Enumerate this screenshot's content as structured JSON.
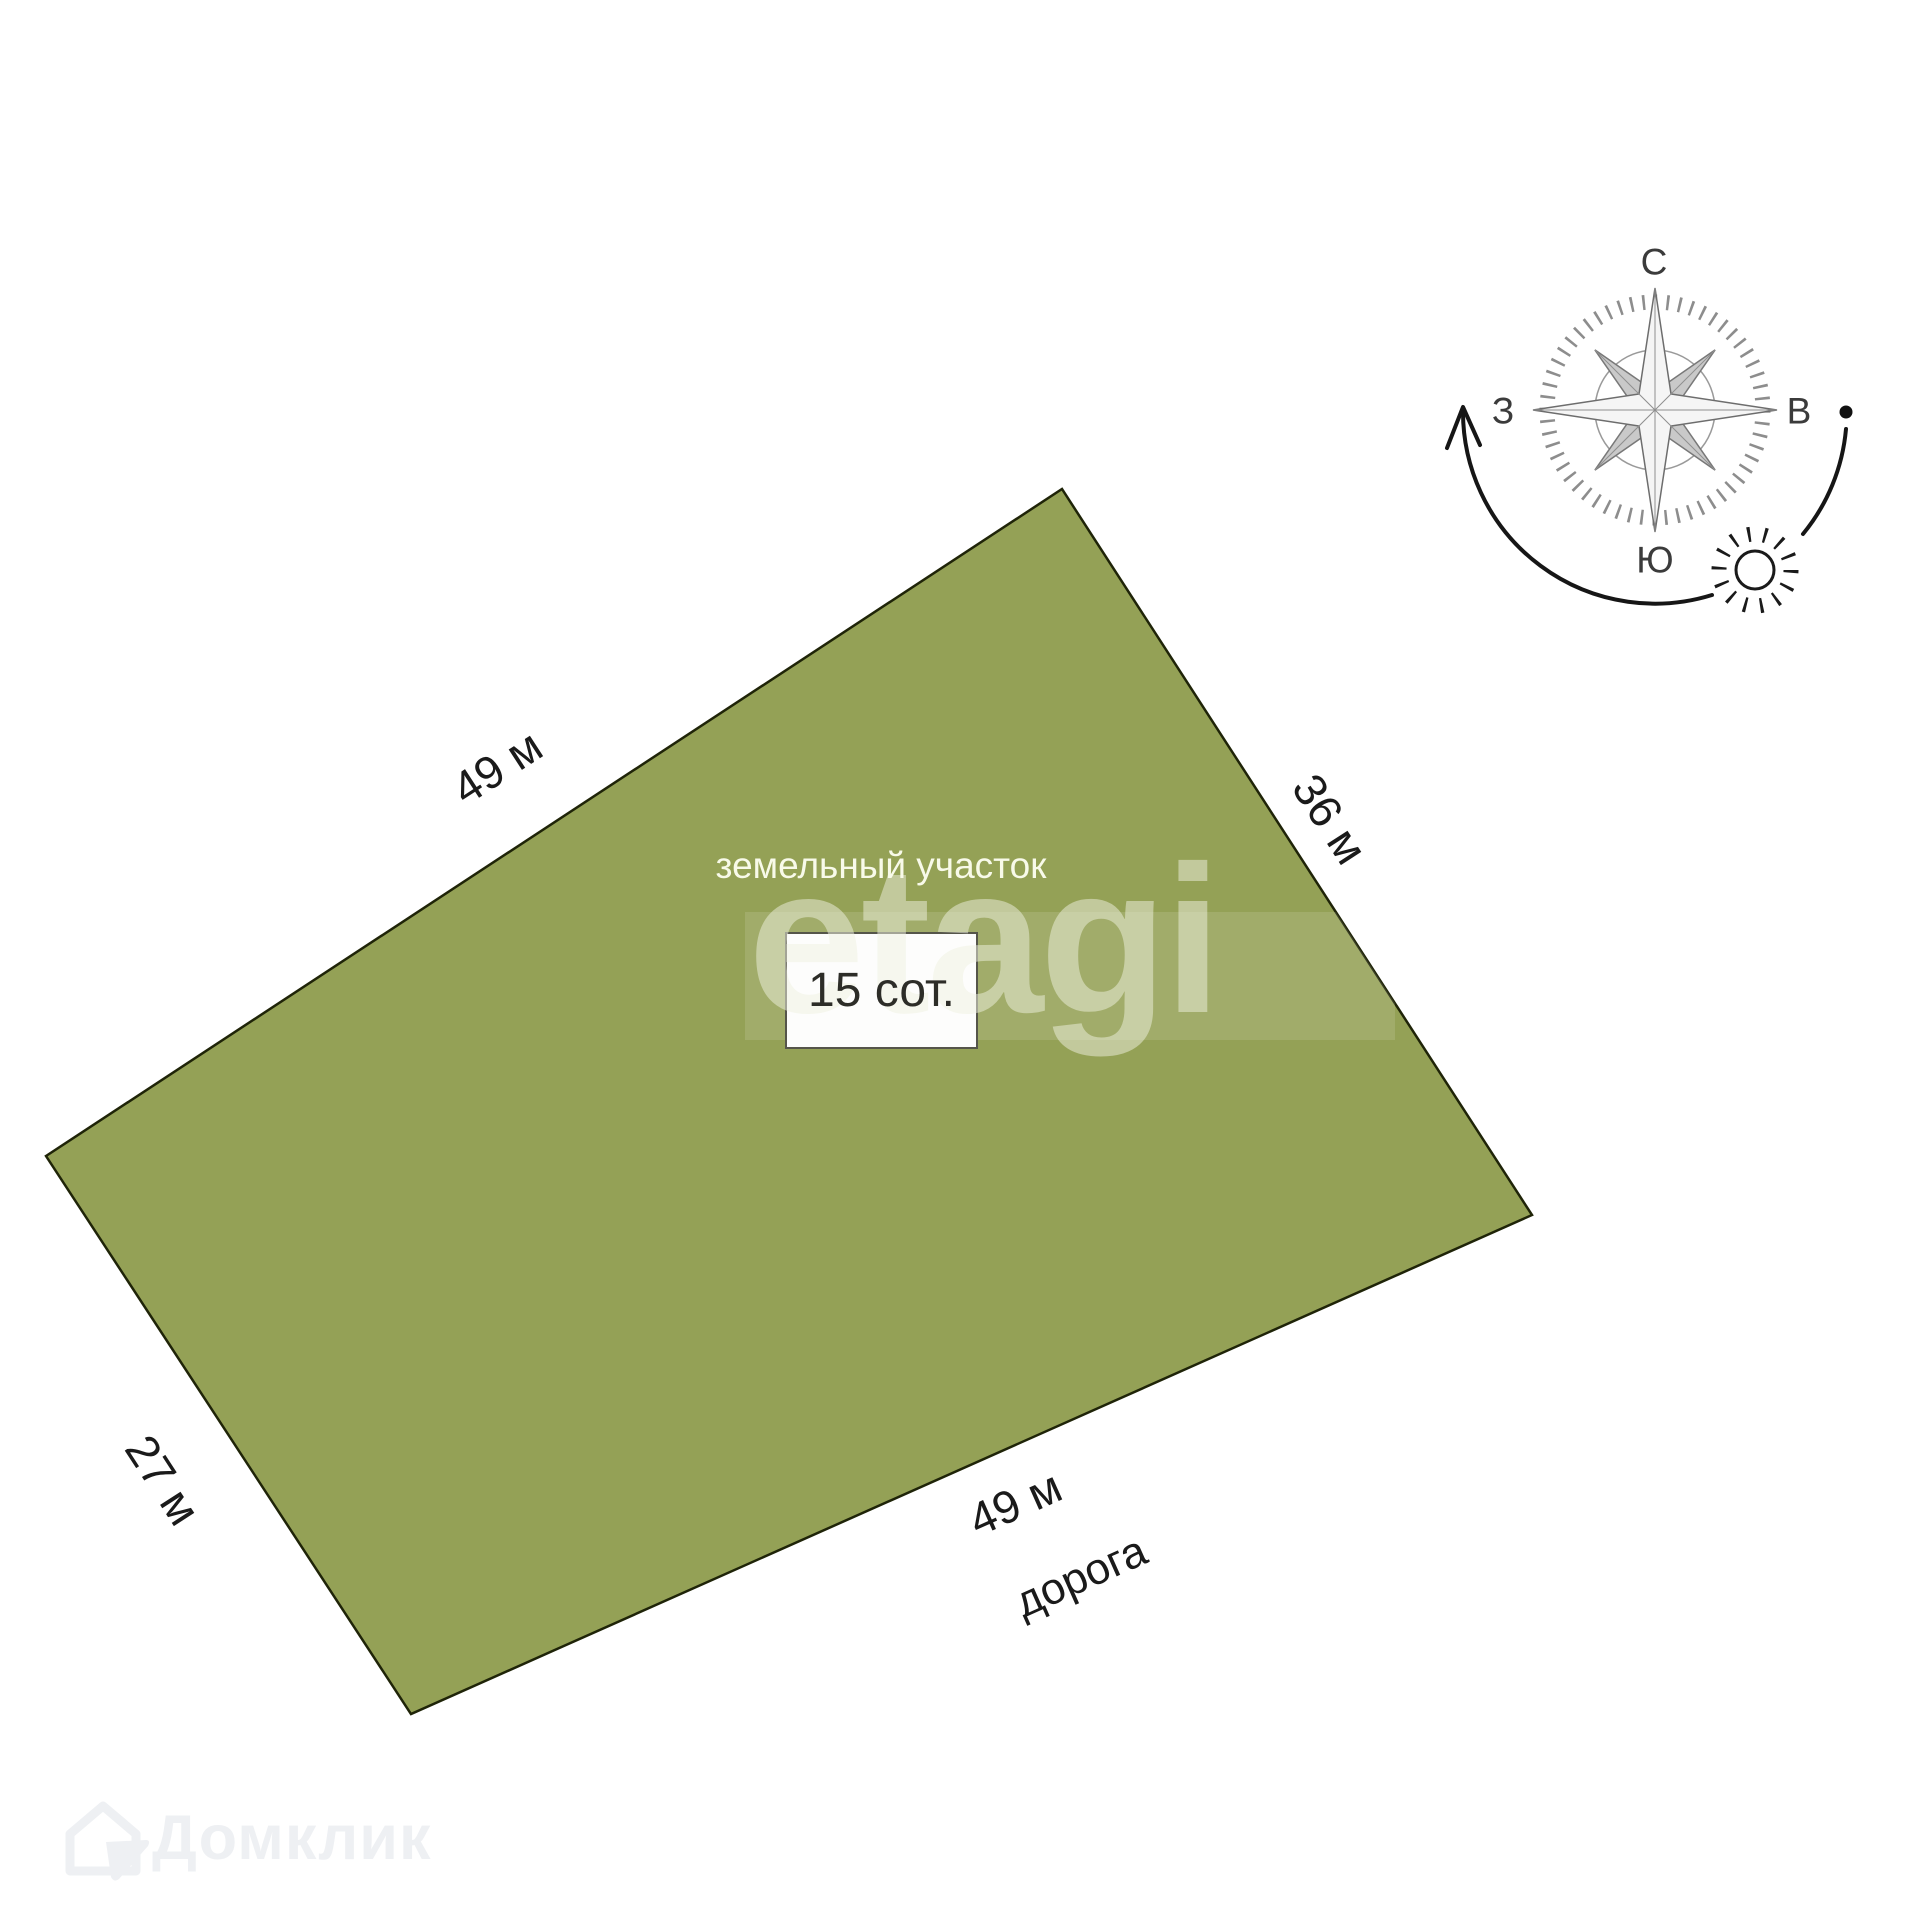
{
  "plot": {
    "label": "земельный участок",
    "area": "15 сот.",
    "dim_top": "49 м",
    "dim_right": "36 м",
    "dim_bottom": "49 м",
    "dim_left": "27 м",
    "road": "дорога",
    "fill_color": "#94a156"
  },
  "compass": {
    "north": "С",
    "south": "Ю",
    "west": "З",
    "east": "В"
  },
  "watermarks": {
    "center": "etagi",
    "footer": "Домклик"
  }
}
